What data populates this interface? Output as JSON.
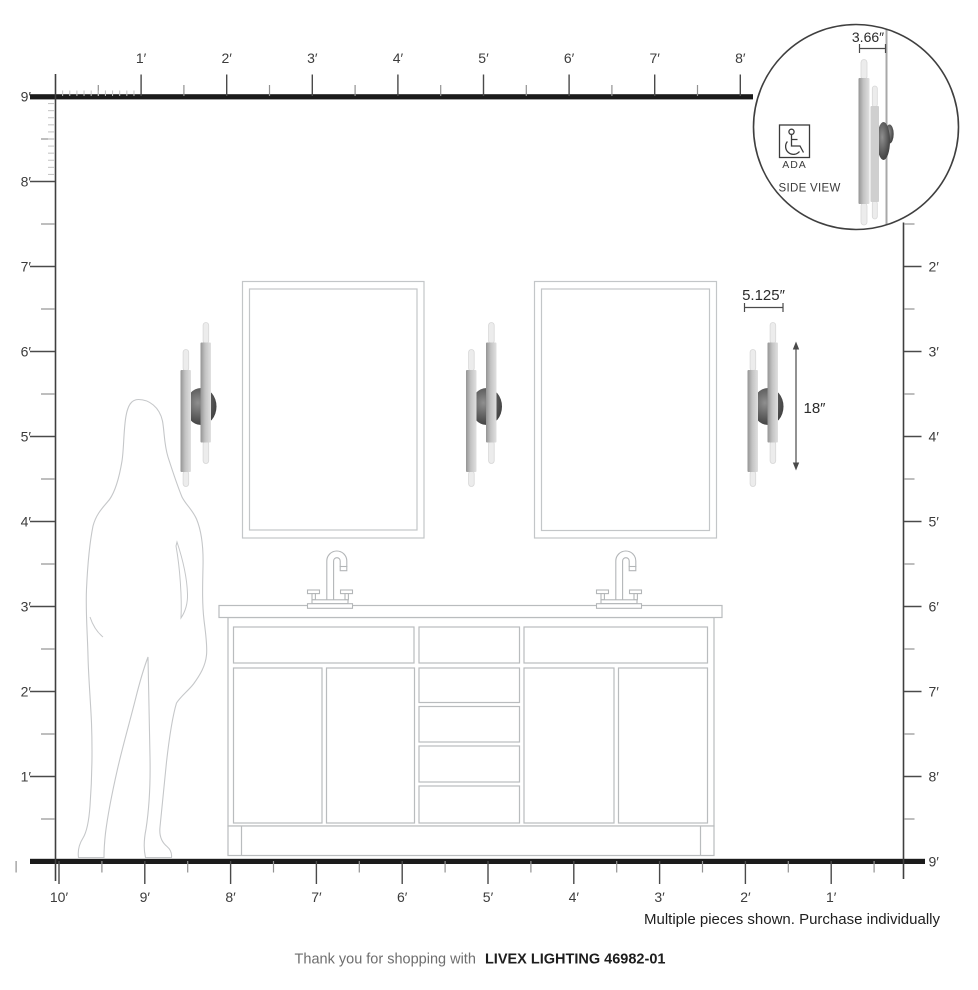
{
  "rulers": {
    "top": {
      "labels": [
        "1′",
        "2′",
        "3′",
        "4′",
        "5′",
        "6′",
        "7′",
        "8′"
      ]
    },
    "left": {
      "labels": [
        "9′",
        "8′",
        "7′",
        "6′",
        "5′",
        "4′",
        "3′",
        "2′",
        "1′"
      ]
    },
    "right": {
      "labels": [
        "2′",
        "3′",
        "4′",
        "5′",
        "6′",
        "7′",
        "8′",
        "9′"
      ]
    },
    "bottom": {
      "labels": [
        "10′",
        "9′",
        "8′",
        "7′",
        "6′",
        "5′",
        "4′",
        "3′",
        "2′",
        "1′"
      ]
    }
  },
  "annotations": {
    "width": "5.125″",
    "height": "18″"
  },
  "inset": {
    "depth": "3.66″",
    "ada": "ADA",
    "view": "SIDE VIEW"
  },
  "note": "Multiple pieces shown. Purchase individually",
  "footer": {
    "prefix": "Thank you for shopping with",
    "brand": "LIVEX LIGHTING 46982-01"
  },
  "colors": {
    "ruler_line": "#1b1b1b",
    "tick_major": "#4a4a4a",
    "tick_minor": "#929292",
    "tick_inch": "#c2c2c2",
    "drawing_outline": "#bcbfc1",
    "fixture_dark": "#3a3a3a"
  }
}
